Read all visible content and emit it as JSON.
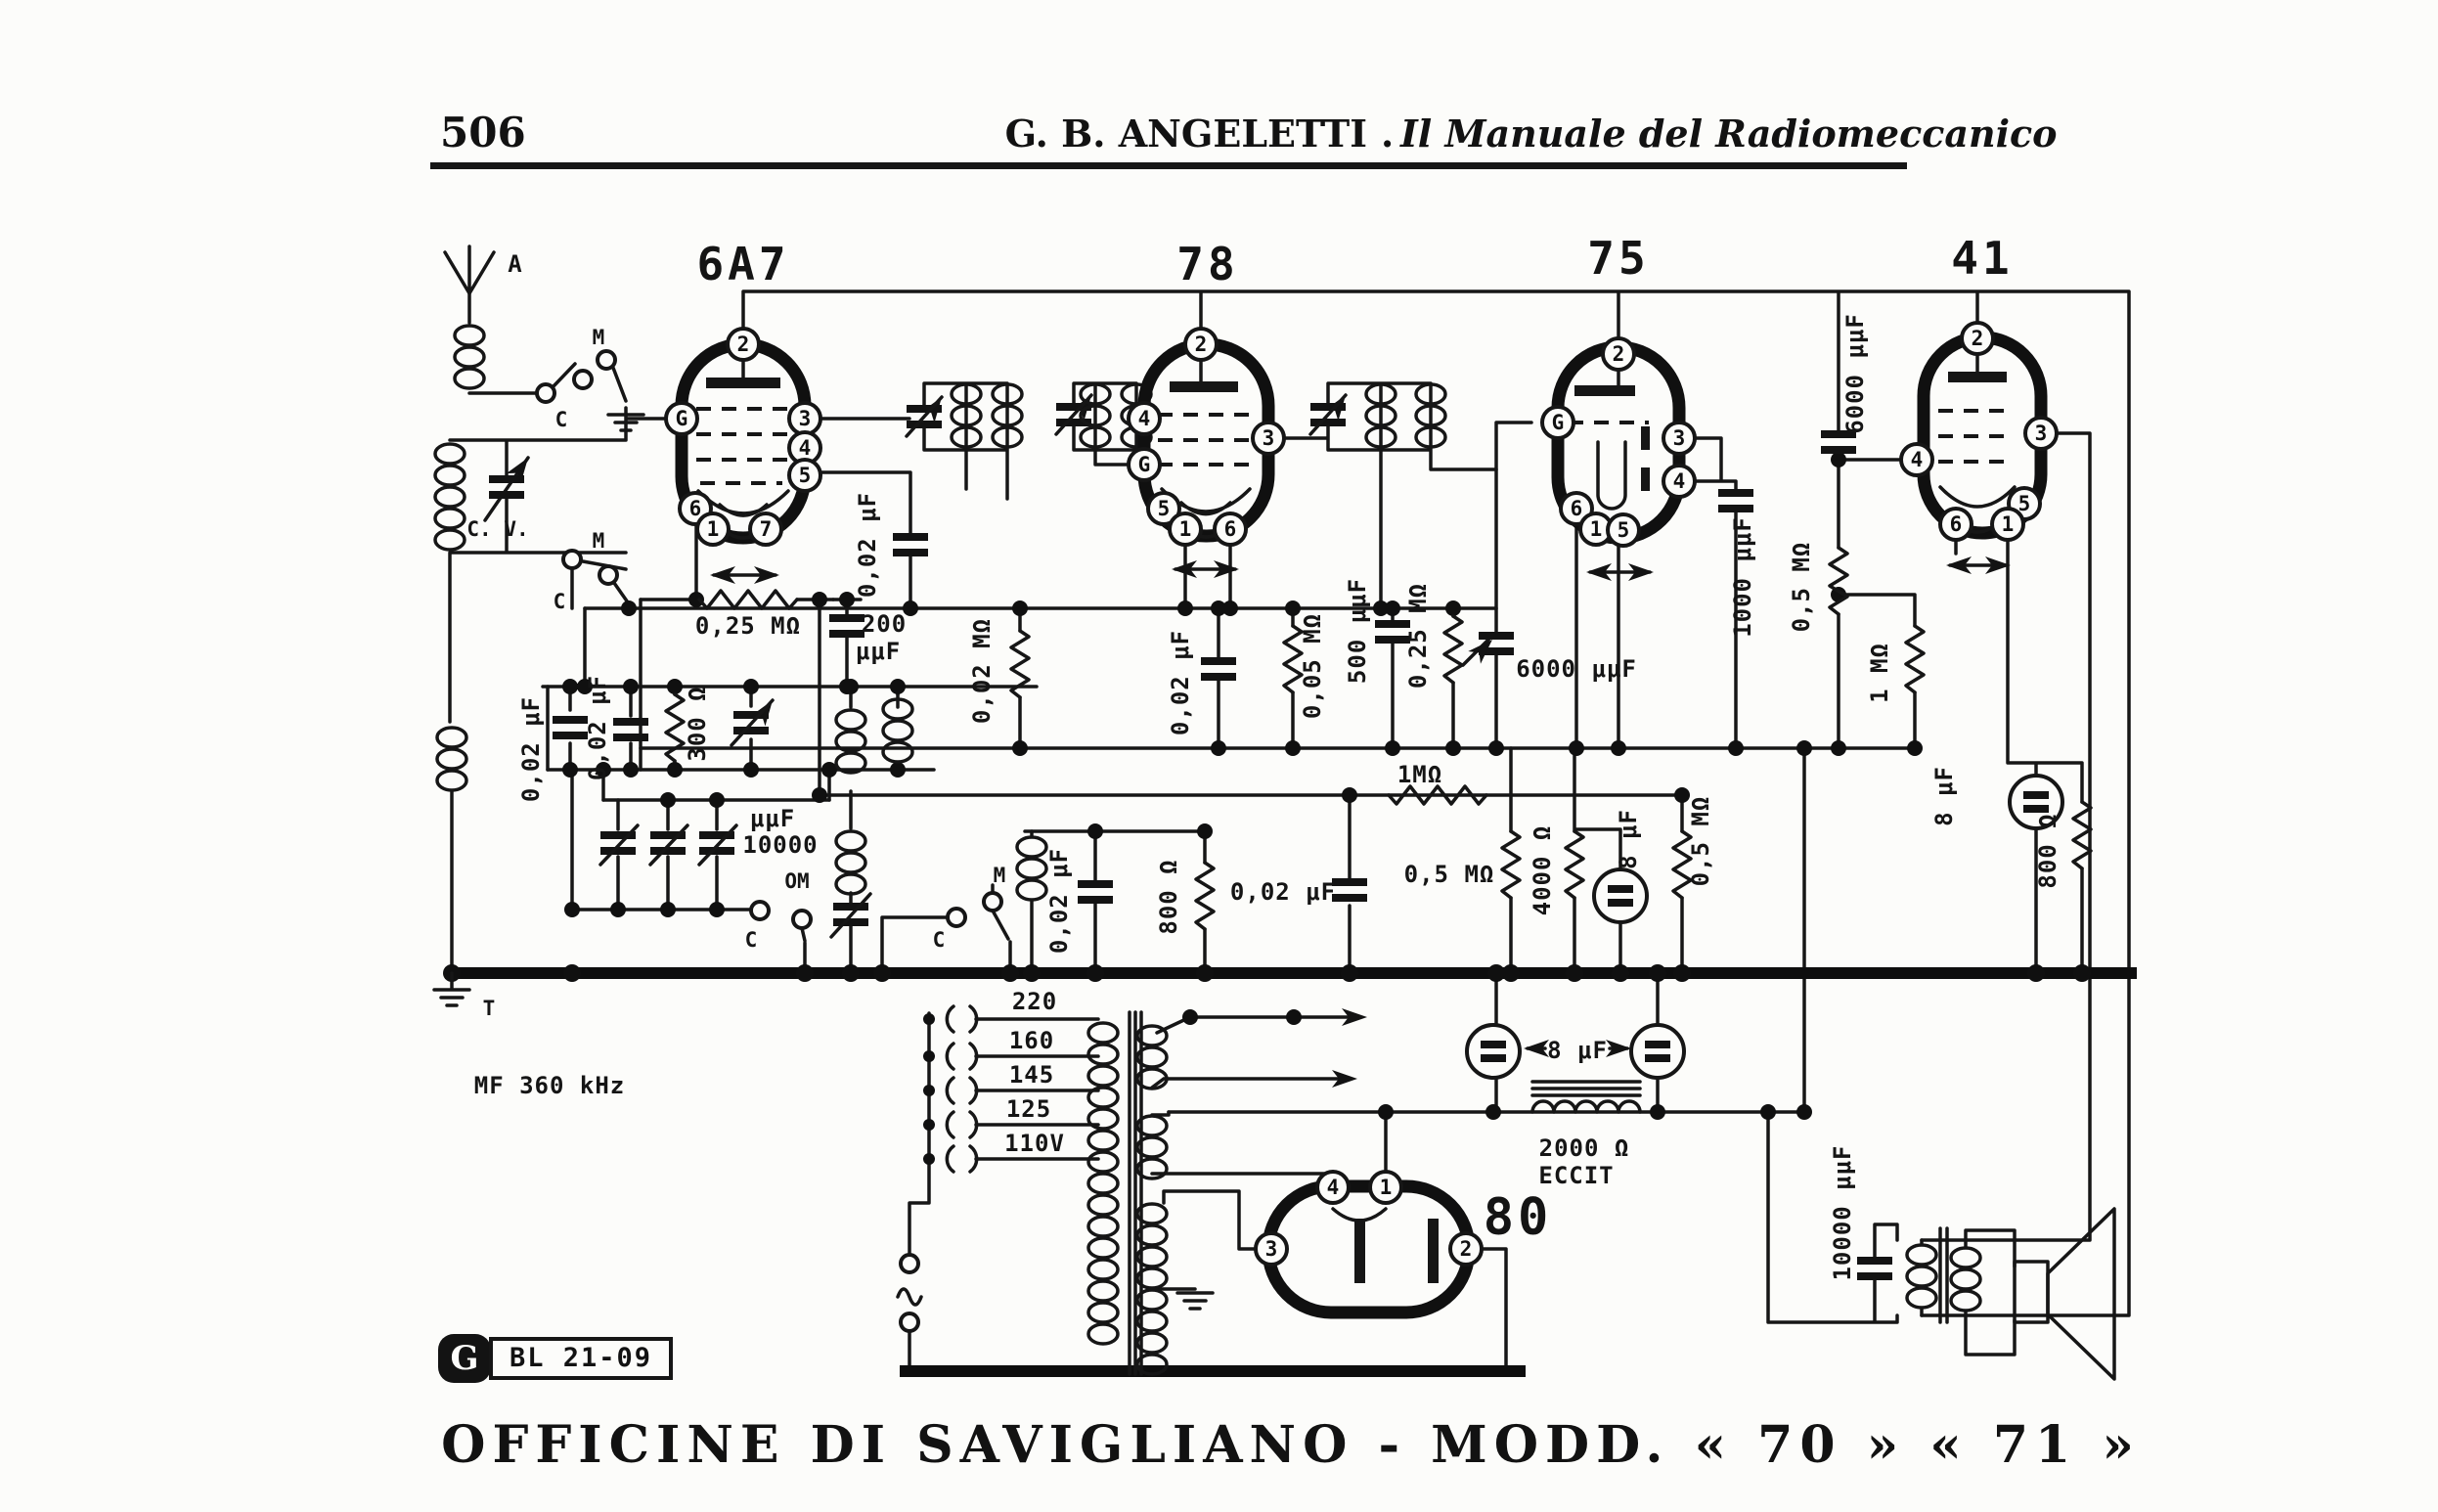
{
  "header": {
    "page": "506",
    "author": "G. B. ANGELETTI",
    "sep": ".",
    "title": "Il Manuale del Radiomeccanico"
  },
  "footer": {
    "text": "OFFICINE DI SAVIGLIANO - MODD. « 70 » « 71 »"
  },
  "stamp": {
    "code": "BL 21-09",
    "glyph": "G"
  },
  "notes": {
    "mf": "MF 360 kHz"
  },
  "tubes": {
    "v1": "6A7",
    "v2": "78",
    "v3": "75",
    "v4": "41",
    "v5": "80"
  },
  "pins": {
    "v1": [
      "2",
      "G",
      "3",
      "4",
      "5",
      "6",
      "1",
      "7"
    ],
    "v2": [
      "2",
      "4",
      "G",
      "3",
      "5",
      "1",
      "6"
    ],
    "v3": [
      "2",
      "G",
      "3",
      "4",
      "6",
      "1",
      "5"
    ],
    "v4": [
      "2",
      "3",
      "4",
      "5",
      "1",
      "6"
    ],
    "v5": [
      "4",
      "1",
      "3",
      "2"
    ]
  },
  "labels": {
    "antenna": "A",
    "ground_t": "T",
    "cv": "C. V.",
    "sw1m": "M",
    "sw1c": "C",
    "sw2m": "M",
    "sw2c": "C",
    "sw3m": "M",
    "sw3c": "C",
    "sw4om": "OM",
    "sw4c": "C"
  },
  "values": {
    "c002_a": "0,02 μF",
    "c002_b": "0,02 μF",
    "r300": "300 Ω",
    "c10000_num": "10000",
    "c10000_unit": "μμF",
    "pot1": "0,25 MΩ",
    "c200_num": "200",
    "c200_unit": "μμF",
    "c002_c": "0,02 μF",
    "r002M": "0,02 MΩ",
    "c002_d": "0,02 μF",
    "r005M": "0,05 MΩ",
    "c500": "500 μμF",
    "r025M": "0,25 MΩ",
    "c6000a": "6000 μμF",
    "c1000": "1000 μμF",
    "r05Ma": "0,5 MΩ",
    "c6000b": "6000 μμF",
    "r1Mv": "1 MΩ",
    "r1Mh": "1MΩ",
    "c002_e": "0,02 μF",
    "r05Mb": "0,5 MΩ",
    "r4000": "4000 Ω",
    "c8a": "8 μF",
    "r05Mc": "0,5 MΩ",
    "c002_f": "0,02 μF",
    "r800a": "800 Ω",
    "c8b": "8 μF",
    "r800b": "800 Ω",
    "c8ps": "8 μF",
    "r2000": "2000 Ω",
    "eccit": "ECCIT",
    "c10000o": "10000 μμF"
  },
  "taps": [
    "220",
    "160",
    "145",
    "125",
    "110V"
  ]
}
